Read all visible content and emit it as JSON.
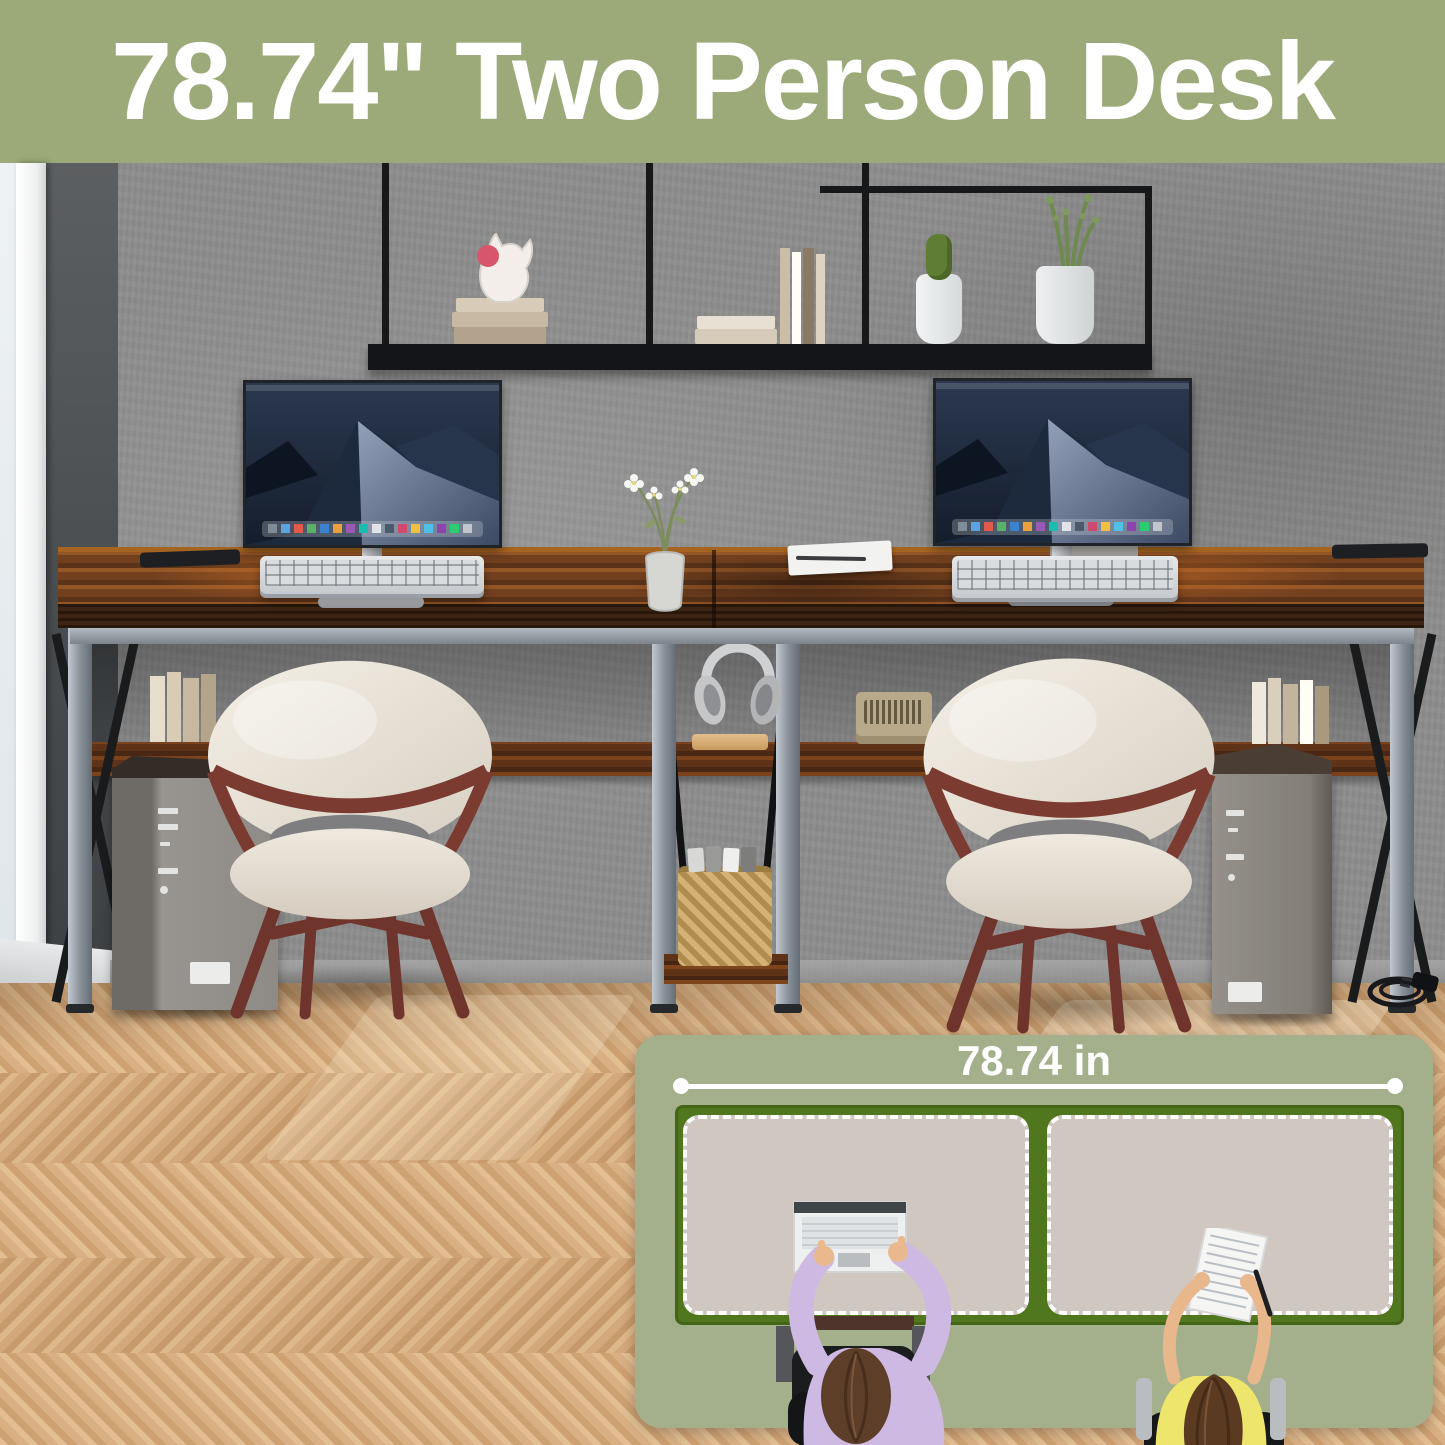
{
  "header": {
    "title": "78.74\" Two Person Desk"
  },
  "inset": {
    "width_label": "78.74 in"
  },
  "colors": {
    "header_bg": "#9BAA78",
    "header_text": "#FFFFFF",
    "panel_bg": "#A4B08C",
    "panel_text": "#FFFFFF",
    "desk_outline": "#50771E",
    "mat_surface": "#D0C8C0",
    "measure_line": "#FFFFFF"
  },
  "scene": {
    "objects": [
      "window",
      "concrete-wall",
      "wall-shelf",
      "books",
      "cat-figurine",
      "cactus-plant",
      "potted-plant",
      "two-person-desk",
      "under-desk-shelf",
      "middle-storage-tower",
      "monitor-left",
      "monitor-right",
      "keyboard-left",
      "keyboard-right",
      "flower-vase",
      "notebook-with-pen",
      "headphones",
      "wicker-basket",
      "cassette-tapes",
      "radio",
      "chair-left",
      "chair-right",
      "pc-tower-left",
      "pc-tower-right",
      "power-plug-cable",
      "herringbone-floor"
    ]
  }
}
